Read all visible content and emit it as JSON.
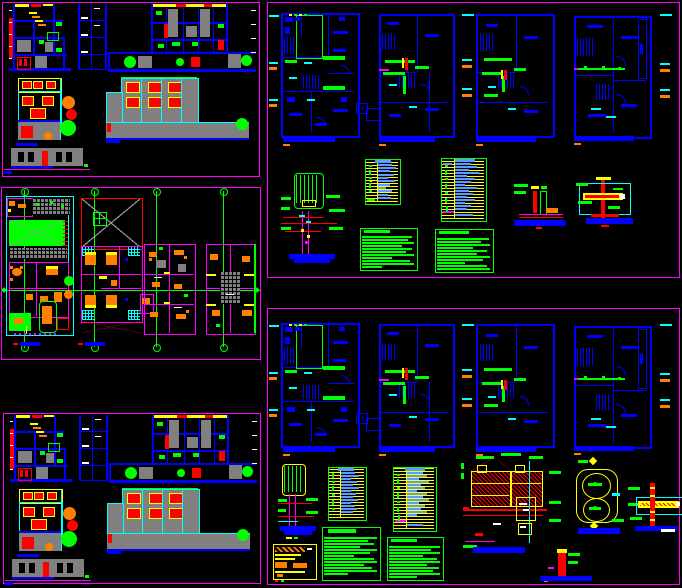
{
  "document": {
    "type": "CAD model-space screenshot",
    "description": "Black-background CAD layout with five magenta-bordered sheet frames: two sections-and-elevations sheets (left top and bottom, near duplicates), one furnished floor-plans sheet (left middle), and two sanitary-installation plan sheets (right top and bottom)."
  },
  "canvas": {
    "width": 682,
    "height": 588,
    "background": "#000000"
  },
  "palette": {
    "black": "#000000",
    "magenta": "#FF00FF",
    "blue": "#0000FF",
    "lightblue": "#5A9CFF",
    "cyan": "#00FFFF",
    "green": "#00FF00",
    "red": "#FF0000",
    "yellow": "#FFFF00",
    "orange": "#FF7F00",
    "gray": "#808080",
    "white": "#FFFFFF"
  },
  "sheets": [
    {
      "id": "sheet-sections-top",
      "region": "top-left",
      "border_color": "#FF00FF",
      "drawings": [
        "building-section-left",
        "structural-grid-elevation",
        "building-section-right",
        "front-elevation",
        "rear-elevation",
        "perimeter-building-elevation"
      ],
      "scale_bars": 3
    },
    {
      "id": "sheet-floor-plans",
      "region": "middle-left",
      "border_color": "#FF00FF",
      "drawings": [
        "site-plan",
        "upper-plan-with-void",
        "furnished-plan",
        "terrace-plan"
      ],
      "axes": {
        "horizontal_green_axes": 1,
        "vertical_green_axes": 4
      },
      "scale_bars": 2
    },
    {
      "id": "sheet-sections-bottom",
      "region": "bottom-left",
      "border_color": "#FF00FF",
      "duplicate_of": "sheet-sections-top"
    },
    {
      "id": "sheet-installations-top",
      "region": "top-right",
      "border_color": "#FF00FF",
      "floor_plans": 4,
      "plan_title_bars": 4,
      "legend_tables": 2,
      "notes_blocks": 2,
      "details": [
        "water-tank-riser",
        "pump-base",
        "wall-sleeve"
      ]
    },
    {
      "id": "sheet-installations-bottom",
      "region": "bottom-right",
      "border_color": "#FF00FF",
      "duplicate_plans_of": "sheet-installations-top",
      "floor_plans": 4,
      "plan_title_bars": 4,
      "legend_tables": 2,
      "notes_blocks": 2,
      "details": [
        "water-tank-riser",
        "materials-table",
        "cistern-section",
        "twin-chamber-plan",
        "valve-cross-section",
        "standpipe"
      ]
    }
  ],
  "legend_table_style": {
    "border": "#00FF00",
    "row_lines": "#FFFF00",
    "entry_bars": "#5A9CFF",
    "symbol_marks": "#00FF00"
  },
  "notes_block_style": {
    "border": "#00FF00",
    "text_bars": "#00FF00"
  },
  "plan_title_bar_color": "#0000FF",
  "text_legibility": "All annotation text is below legible resolution; labels are depicted as solid color bars"
}
